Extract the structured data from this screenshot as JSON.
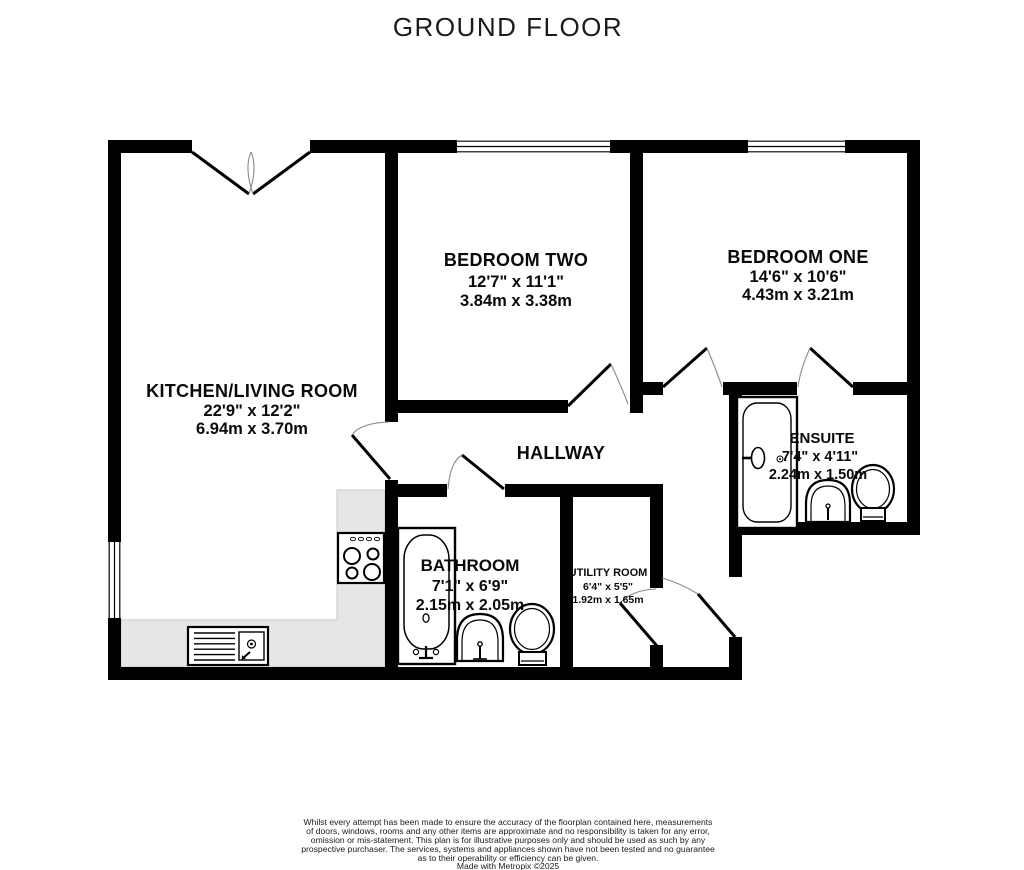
{
  "title": "GROUND FLOOR",
  "floorplan": {
    "rooms": [
      {
        "name": "KITCHEN/LIVING ROOM",
        "imperial": "22'9\" x 12'2\"",
        "metric": "6.94m x 3.70m"
      },
      {
        "name": "BEDROOM TWO",
        "imperial": "12'7\" x 11'1\"",
        "metric": "3.84m x 3.38m"
      },
      {
        "name": "BEDROOM ONE",
        "imperial": "14'6\" x 10'6\"",
        "metric": "4.43m x 3.21m"
      },
      {
        "name": "HALLWAY",
        "imperial": "",
        "metric": ""
      },
      {
        "name": "BATHROOM",
        "imperial": "7'1\" x 6'9\"",
        "metric": "2.15m x 2.05m"
      },
      {
        "name": "UTILITY ROOM",
        "imperial": "6'4\" x 5'5\"",
        "metric": "1.92m x 1.65m"
      },
      {
        "name": "ENSUITE",
        "imperial": "7'4\" x 4'11\"",
        "metric": "2.24m x 1.50m"
      }
    ],
    "fixtures": [
      "double-entry-doors",
      "window",
      "bathtub",
      "shower",
      "toilet",
      "sink",
      "hob",
      "kitchen-sink",
      "counter"
    ],
    "colors": {
      "wall": "#000000",
      "counter": "#e6e6e6",
      "door_arc": "#8a8a8a",
      "background": "#ffffff"
    }
  },
  "footer": {
    "disclaimer_lines": [
      "Whilst every attempt has been made to ensure the accuracy of the floorplan contained here, measurements",
      "of doors, windows, rooms and any other items are approximate and no responsibility is taken for any error,",
      "omission or mis-statement. This plan is for illustrative purposes only and should be used as such by any",
      "prospective purchaser. The services, systems and appliances shown have not been tested and no guarantee",
      "as to their operability or efficiency can be given.",
      "Made with Metropix ©2025"
    ]
  }
}
